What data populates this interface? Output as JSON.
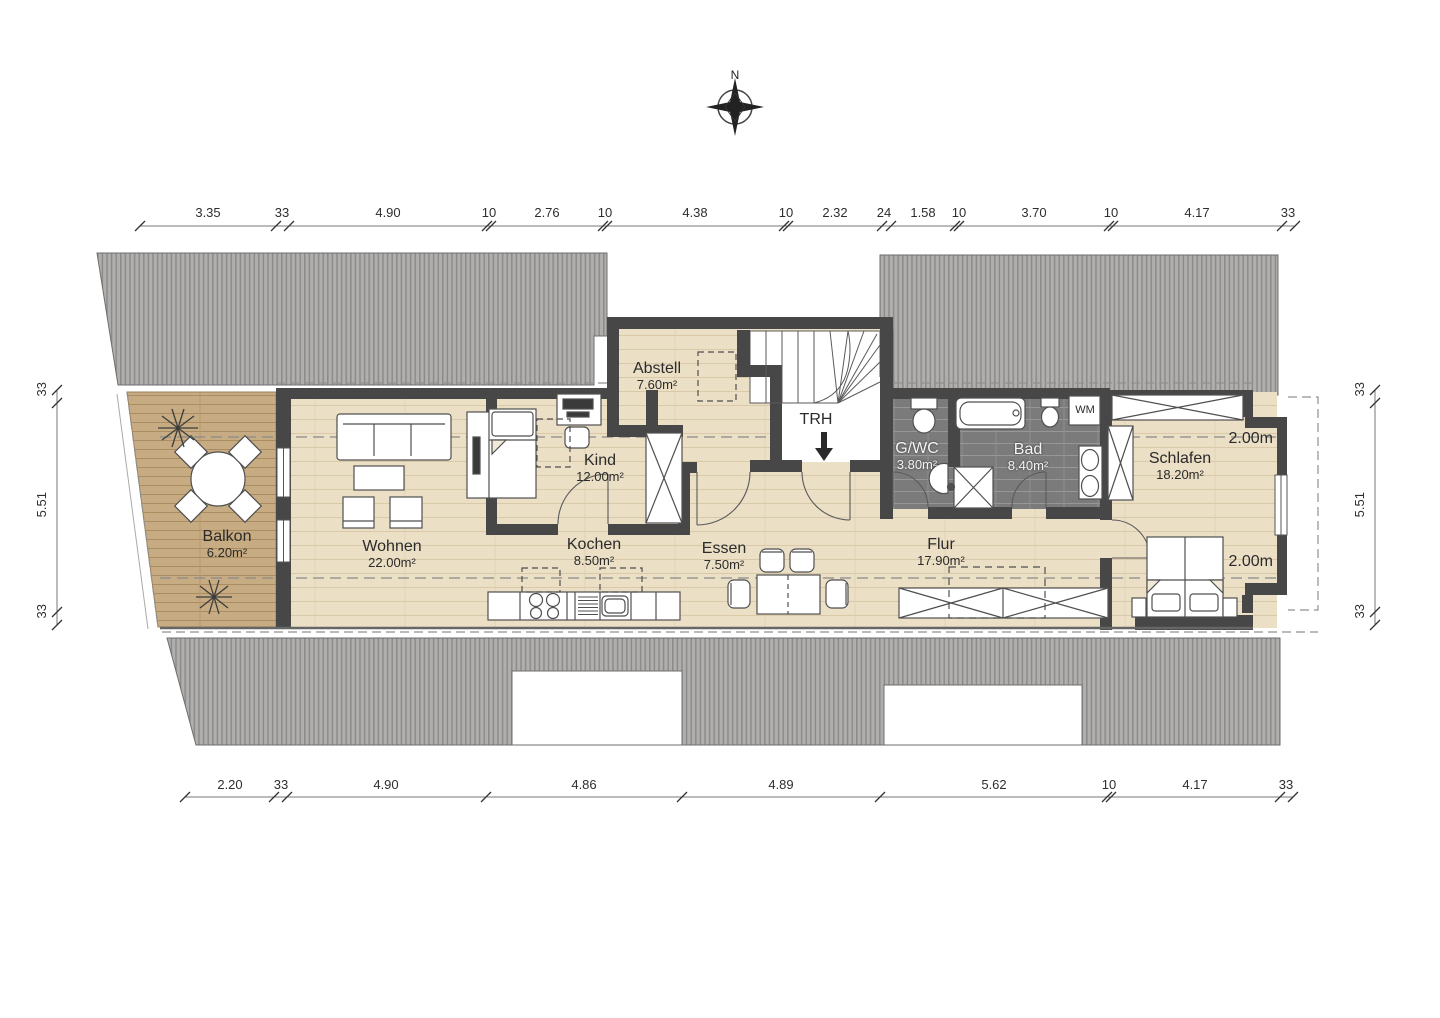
{
  "compass": {
    "north_label": "N"
  },
  "rooms": {
    "balkon": {
      "name": "Balkon",
      "area": "6.20m²"
    },
    "wohnen": {
      "name": "Wohnen",
      "area": "22.00m²"
    },
    "kind": {
      "name": "Kind",
      "area": "12.00m²"
    },
    "kochen": {
      "name": "Kochen",
      "area": "8.50m²"
    },
    "essen": {
      "name": "Essen",
      "area": "7.50m²"
    },
    "abstell": {
      "name": "Abstell",
      "area": "7.60m²"
    },
    "trh": {
      "name": "TRH"
    },
    "gwc": {
      "name": "G/WC",
      "area": "3.80m²"
    },
    "bad": {
      "name": "Bad",
      "area": "8.40m²"
    },
    "flur": {
      "name": "Flur",
      "area": "17.90m²"
    },
    "schlafen": {
      "name": "Schlafen",
      "area": "18.20m²"
    }
  },
  "labels": {
    "wm": "WM",
    "headroom_top": "2.00m",
    "headroom_bottom": "2.00m"
  },
  "dimensions": {
    "top": [
      "3.35",
      "33",
      "4.90",
      "10",
      "2.76",
      "10",
      "4.38",
      "10",
      "2.32",
      "24",
      "1.58",
      "10",
      "3.70",
      "10",
      "4.17",
      "33"
    ],
    "bottom": [
      "2.20",
      "33",
      "4.90",
      "4.86",
      "4.89",
      "5.62",
      "10",
      "4.17",
      "33"
    ],
    "left": [
      "33",
      "5.51",
      "33"
    ],
    "right": [
      "33",
      "5.51",
      "33"
    ]
  }
}
